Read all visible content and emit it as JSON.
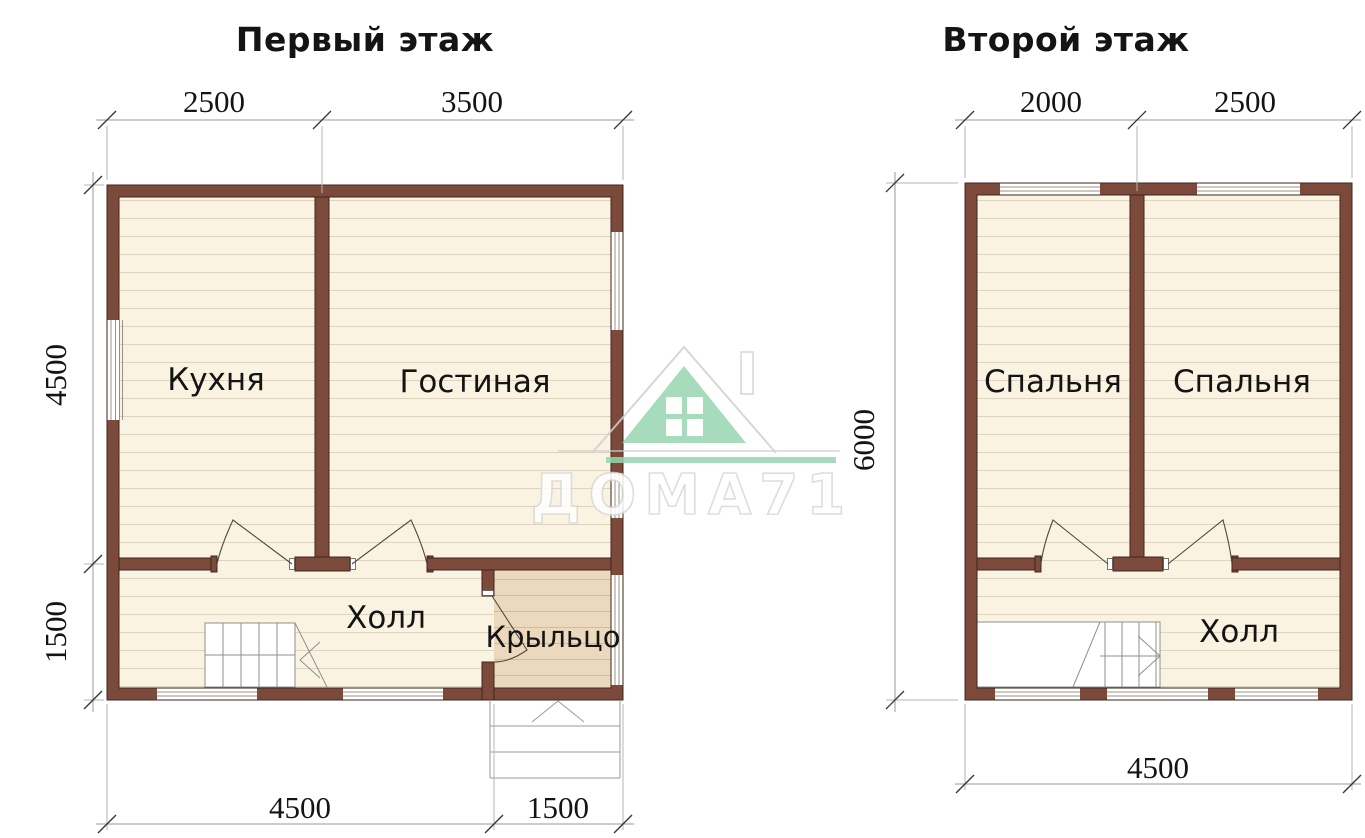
{
  "plans": {
    "first": {
      "title": "Первый этаж",
      "dims": {
        "top_left": "2500",
        "top_right": "3500",
        "side_upper": "4500",
        "side_lower": "1500",
        "bottom_main": "4500",
        "bottom_porch": "1500"
      },
      "rooms": {
        "kitchen": "Кухня",
        "living": "Гостиная",
        "hall": "Холл",
        "porch": "Крыльцо"
      }
    },
    "second": {
      "title": "Второй этаж",
      "dims": {
        "top_left": "2000",
        "top_right": "2500",
        "side": "6000",
        "bottom": "4500"
      },
      "rooms": {
        "bedroom1": "Спальня",
        "bedroom2": "Спальня",
        "hall": "Холл"
      }
    }
  },
  "watermark": {
    "text": "ДОМА71"
  },
  "colors": {
    "wall": "#7b4a3a",
    "wall_outline": "#3f2620",
    "floor": "#faf3e2",
    "floor_line": "#ded3c0",
    "porch_floor": "#ecd9bd",
    "porch_line": "#d2bc99",
    "logo_green": "#97d6b0"
  }
}
